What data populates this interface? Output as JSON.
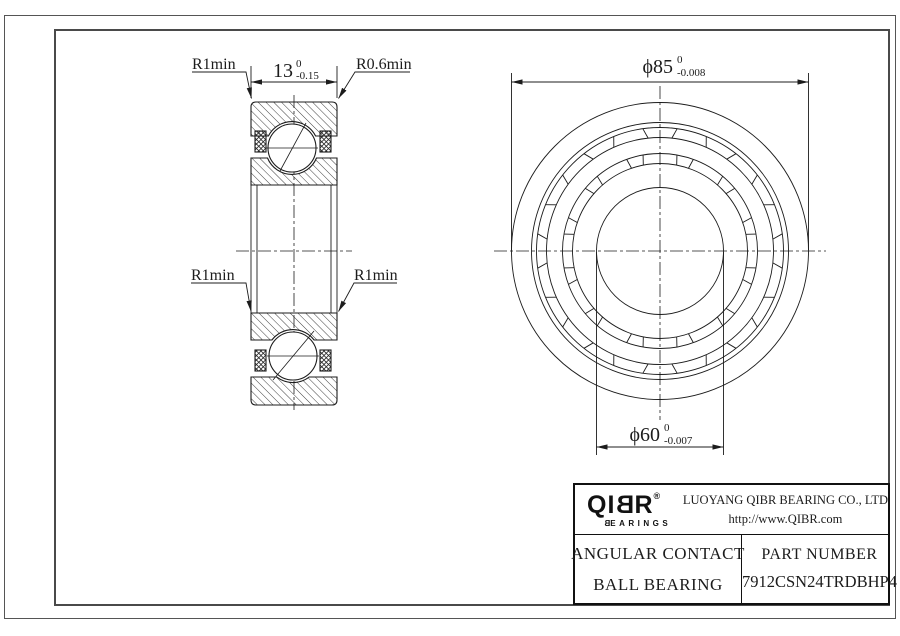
{
  "colors": {
    "line": "#1c1c1c",
    "frame": "#555555",
    "bg": "#ffffff"
  },
  "section_view": {
    "label_r1min_top": "R1min",
    "label_r06min": "R0.6min",
    "label_r1min_left": "R1min",
    "label_r1min_right": "R1min",
    "width_dim": {
      "value": "13",
      "tol_upper": "0",
      "tol_lower": "-0.15"
    }
  },
  "front_view": {
    "od_dim": {
      "value": "ϕ85",
      "tol_upper": "0",
      "tol_lower": "-0.008"
    },
    "bore_dim": {
      "value": "ϕ60",
      "tol_upper": "0",
      "tol_lower": "-0.007"
    },
    "geometry": {
      "cx": 660,
      "cy": 251,
      "radii": [
        148.5,
        128.5,
        123.5,
        113.5,
        97.5,
        87.5,
        63.5
      ],
      "pocket_bands": [
        {
          "r_out": 123.5,
          "r_in": 113.5,
          "count": 12,
          "offset_deg": 0,
          "half_out_deg": 8,
          "half_in_deg": 6
        },
        {
          "r_out": 97.5,
          "r_in": 87.5,
          "count": 12,
          "offset_deg": 15,
          "half_out_deg": 5,
          "half_in_deg": 4
        }
      ]
    }
  },
  "title_block": {
    "brand_prefix": "QI",
    "brand_b": "B",
    "brand_suffix": "R",
    "registered": "®",
    "brand_sub_b": "B",
    "brand_sub_rest": "EARINGS",
    "company_line1": "LUOYANG QIBR BEARING CO., LTD",
    "company_line2": "http://www.QIBR.com",
    "product_line1": "ANGULAR CONTACT",
    "product_line2": "BALL BEARING",
    "part_label": "PART NUMBER",
    "part_number": "7912CSN24TRDBHP4"
  }
}
